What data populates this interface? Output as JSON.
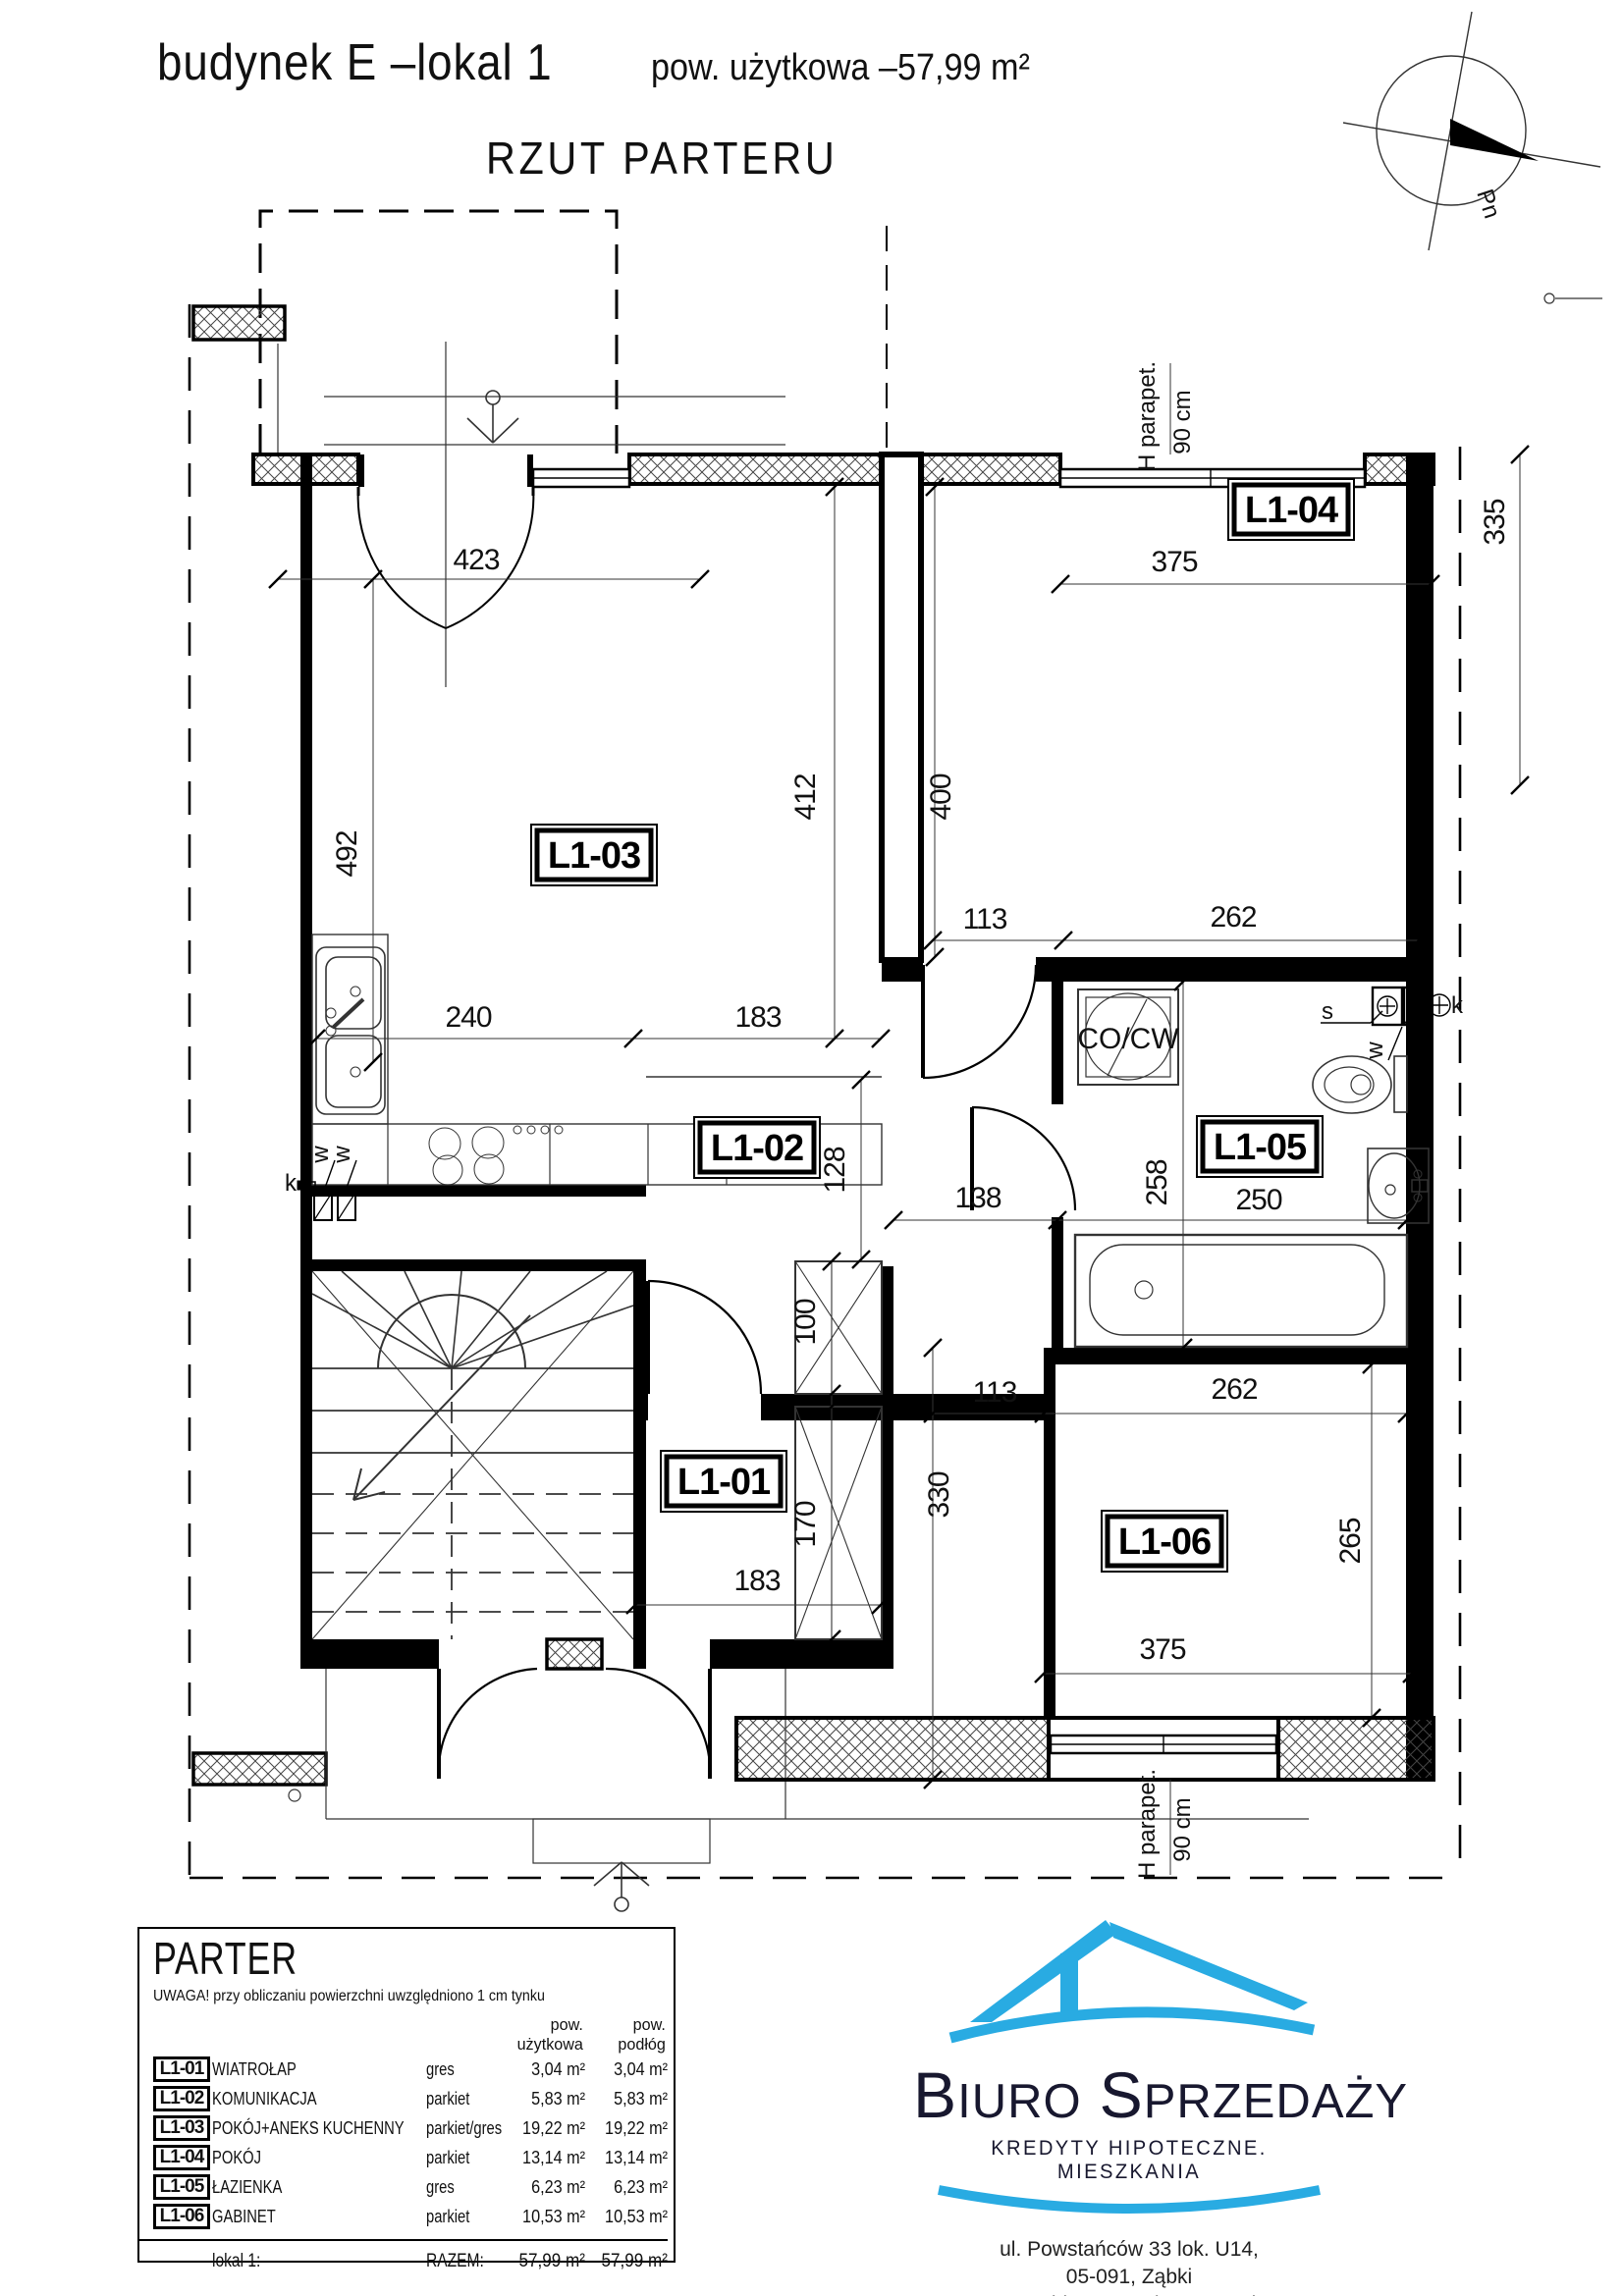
{
  "header": {
    "title": "budynek E –lokal 1",
    "area_label": "pow. użytkowa –57,99 m²",
    "subtitle": "RZUT PARTERU"
  },
  "compass": {
    "north_label": "Pn"
  },
  "plan": {
    "room_labels": {
      "l101": "L1-01",
      "l102": "L1-02",
      "l103": "L1-03",
      "l104": "L1-04",
      "l105": "L1-05",
      "l106": "L1-06"
    },
    "dims": {
      "d423": "423",
      "d375_top": "375",
      "d492": "492",
      "d412": "412",
      "d400": "400",
      "d335": "335",
      "d240": "240",
      "d183_mid": "183",
      "d113_top": "113",
      "d262_top": "262",
      "d128": "128",
      "d138": "138",
      "d258": "258",
      "d250": "250",
      "d100": "100",
      "d170": "170",
      "d183_bottom": "183",
      "d113_bottom": "113",
      "d262_bottom": "262",
      "d330": "330",
      "d265": "265",
      "d375_bottom": "375"
    },
    "annotations": {
      "boiler": "CO/CW",
      "parapet": "H parapet.",
      "parapet_height": "90 cm",
      "vent_s": "s",
      "vent_w": "w",
      "vent_k": "k"
    }
  },
  "legend": {
    "title": "PARTER",
    "note": "UWAGA! przy obliczaniu powierzchni uwzględniono 1 cm tynku",
    "col_usable": "pow. użytkowa",
    "col_floor": "pow. podłóg",
    "rows": [
      {
        "id": "L1-01",
        "name": "WIATROŁAP",
        "material": "gres",
        "usable": "3,04 m²",
        "floor": "3,04 m²"
      },
      {
        "id": "L1-02",
        "name": "KOMUNIKACJA",
        "material": "parkiet",
        "usable": "5,83 m²",
        "floor": "5,83 m²"
      },
      {
        "id": "L1-03",
        "name": "POKÓJ+ANEKS KUCHENNY",
        "material": "parkiet/gres",
        "usable": "19,22 m²",
        "floor": "19,22 m²"
      },
      {
        "id": "L1-04",
        "name": "POKÓJ",
        "material": "parkiet",
        "usable": "13,14 m²",
        "floor": "13,14 m²"
      },
      {
        "id": "L1-05",
        "name": "ŁAZIENKA",
        "material": "gres",
        "usable": "6,23 m²",
        "floor": "6,23 m²"
      },
      {
        "id": "L1-06",
        "name": "GABINET",
        "material": "parkiet",
        "usable": "10,53 m²",
        "floor": "10,53 m²"
      }
    ],
    "total_label": "lokal 1:",
    "total_key": "RAZEM:",
    "total_usable": "57,99 m²",
    "total_floor": "57,99 m²"
  },
  "logo": {
    "name_word1": "Biuro",
    "name_word2": "Sprzedaży",
    "tagline": "KREDYTY HIPOTECZNE. MIESZKANIA",
    "address1": "ul. Powstańców 33 lok. U14,",
    "address2": "05-091, Ząbki",
    "website": "www.biurosprzedazy.com.pl",
    "email": "biuro@biurosprzedazy.com.pl",
    "phone": "tel. 604 771 746",
    "brand_blue": "#29abe2"
  }
}
